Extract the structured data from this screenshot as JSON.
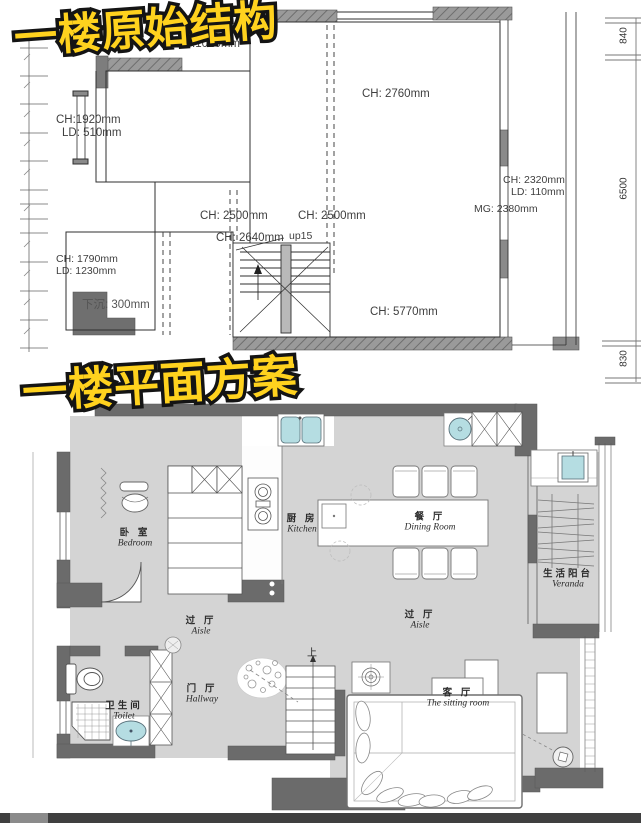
{
  "titles": {
    "top": "一楼原始结构",
    "bottom": "一楼平面方案"
  },
  "colors": {
    "title_fill": "#ffd21e",
    "title_outline": "#141414",
    "wall_top_plan": "#969696",
    "wall_plan": "#6b6b6b",
    "floor": "#d4d4d4",
    "fixture_teal": "#b5dde2",
    "line": "#2f2f2f",
    "bottom_bar": "#3f3f3f"
  },
  "original_plan": {
    "labels": {
      "top_partial": "mm",
      "top_ld": "LD:1020mm",
      "ch_2760": "CH: 2760mm",
      "ch_1920": "CH:1920mm",
      "ld_510": "LD: 510mm",
      "ch_2500_a": "CH: 2500mm",
      "ch_2500_b": "CH: 2500mm",
      "ch_2640": "CH: 2640mm",
      "up15": "up15",
      "ch_5770": "CH: 5770mm",
      "ch_2320": "CH: 2320mm",
      "ld_110": "LD: 110mm",
      "mg_2380": "MG: 2380mm",
      "ch_1790": "CH: 1790mm",
      "ld_1230": "LD: 1230mm",
      "sunken": "下沉: 300mm"
    },
    "right_dims": [
      "840",
      "6500",
      "830"
    ]
  },
  "floor_plan": {
    "rooms": [
      {
        "key": "bedroom",
        "zh": "卧 室",
        "en": "Bedroom"
      },
      {
        "key": "kitchen",
        "zh": "厨 房",
        "en": "Kitchen"
      },
      {
        "key": "dining",
        "zh": "餐 厅",
        "en": "Dining Room"
      },
      {
        "key": "veranda",
        "zh": "生活阳台",
        "en": "Veranda"
      },
      {
        "key": "aisle_left",
        "zh": "过 厅",
        "en": "Aisle"
      },
      {
        "key": "aisle_right",
        "zh": "过 厅",
        "en": "Aisle"
      },
      {
        "key": "hallway",
        "zh": "门 厅",
        "en": "Hallway"
      },
      {
        "key": "toilet",
        "zh": "卫生间",
        "en": "Toilet"
      },
      {
        "key": "sitting",
        "zh": "客 厅",
        "en": "The sitting room"
      }
    ],
    "stairs_up": "上"
  }
}
